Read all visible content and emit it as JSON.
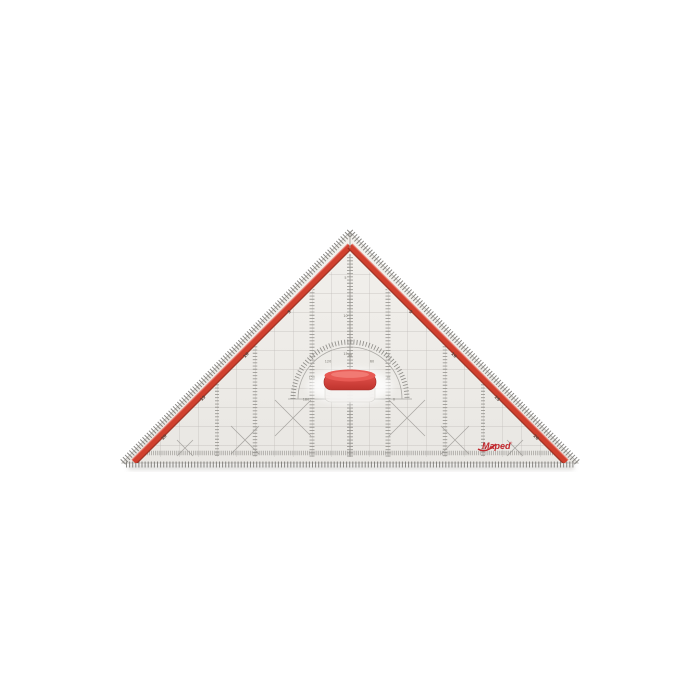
{
  "page": {
    "background": "#ffffff"
  },
  "product": {
    "brand": "Maped",
    "kind": "geometry set square with handle (product photo)",
    "colors": {
      "body": "#edebe7",
      "grid_line": "#b6b3af",
      "edge_ticks": "#7d7b77",
      "red_stripe": "#d0402e",
      "red_stripe_dark": "#952a1c",
      "handle_red": "#d9453e",
      "logo_red": "#c1272d"
    }
  },
  "logo": {
    "text": "Maped",
    "registered": "®"
  },
  "scales": {
    "bottom_numbers": [
      "11",
      "10",
      "9",
      "8",
      "7",
      "6",
      "5",
      "4",
      "3",
      "2",
      "1",
      "0",
      "1",
      "2",
      "3",
      "4",
      "5",
      "6",
      "7",
      "8",
      "9",
      "10",
      "11"
    ],
    "left_stripe_numbers": [
      "5",
      "10",
      "15",
      "20"
    ],
    "right_stripe_numbers": [
      "5",
      "10",
      "15",
      "20"
    ],
    "center_numbers": [
      "5",
      "10",
      "15"
    ],
    "protractor_numbers": [
      "180",
      "150",
      "120",
      "90",
      "60",
      "30",
      "0"
    ]
  }
}
